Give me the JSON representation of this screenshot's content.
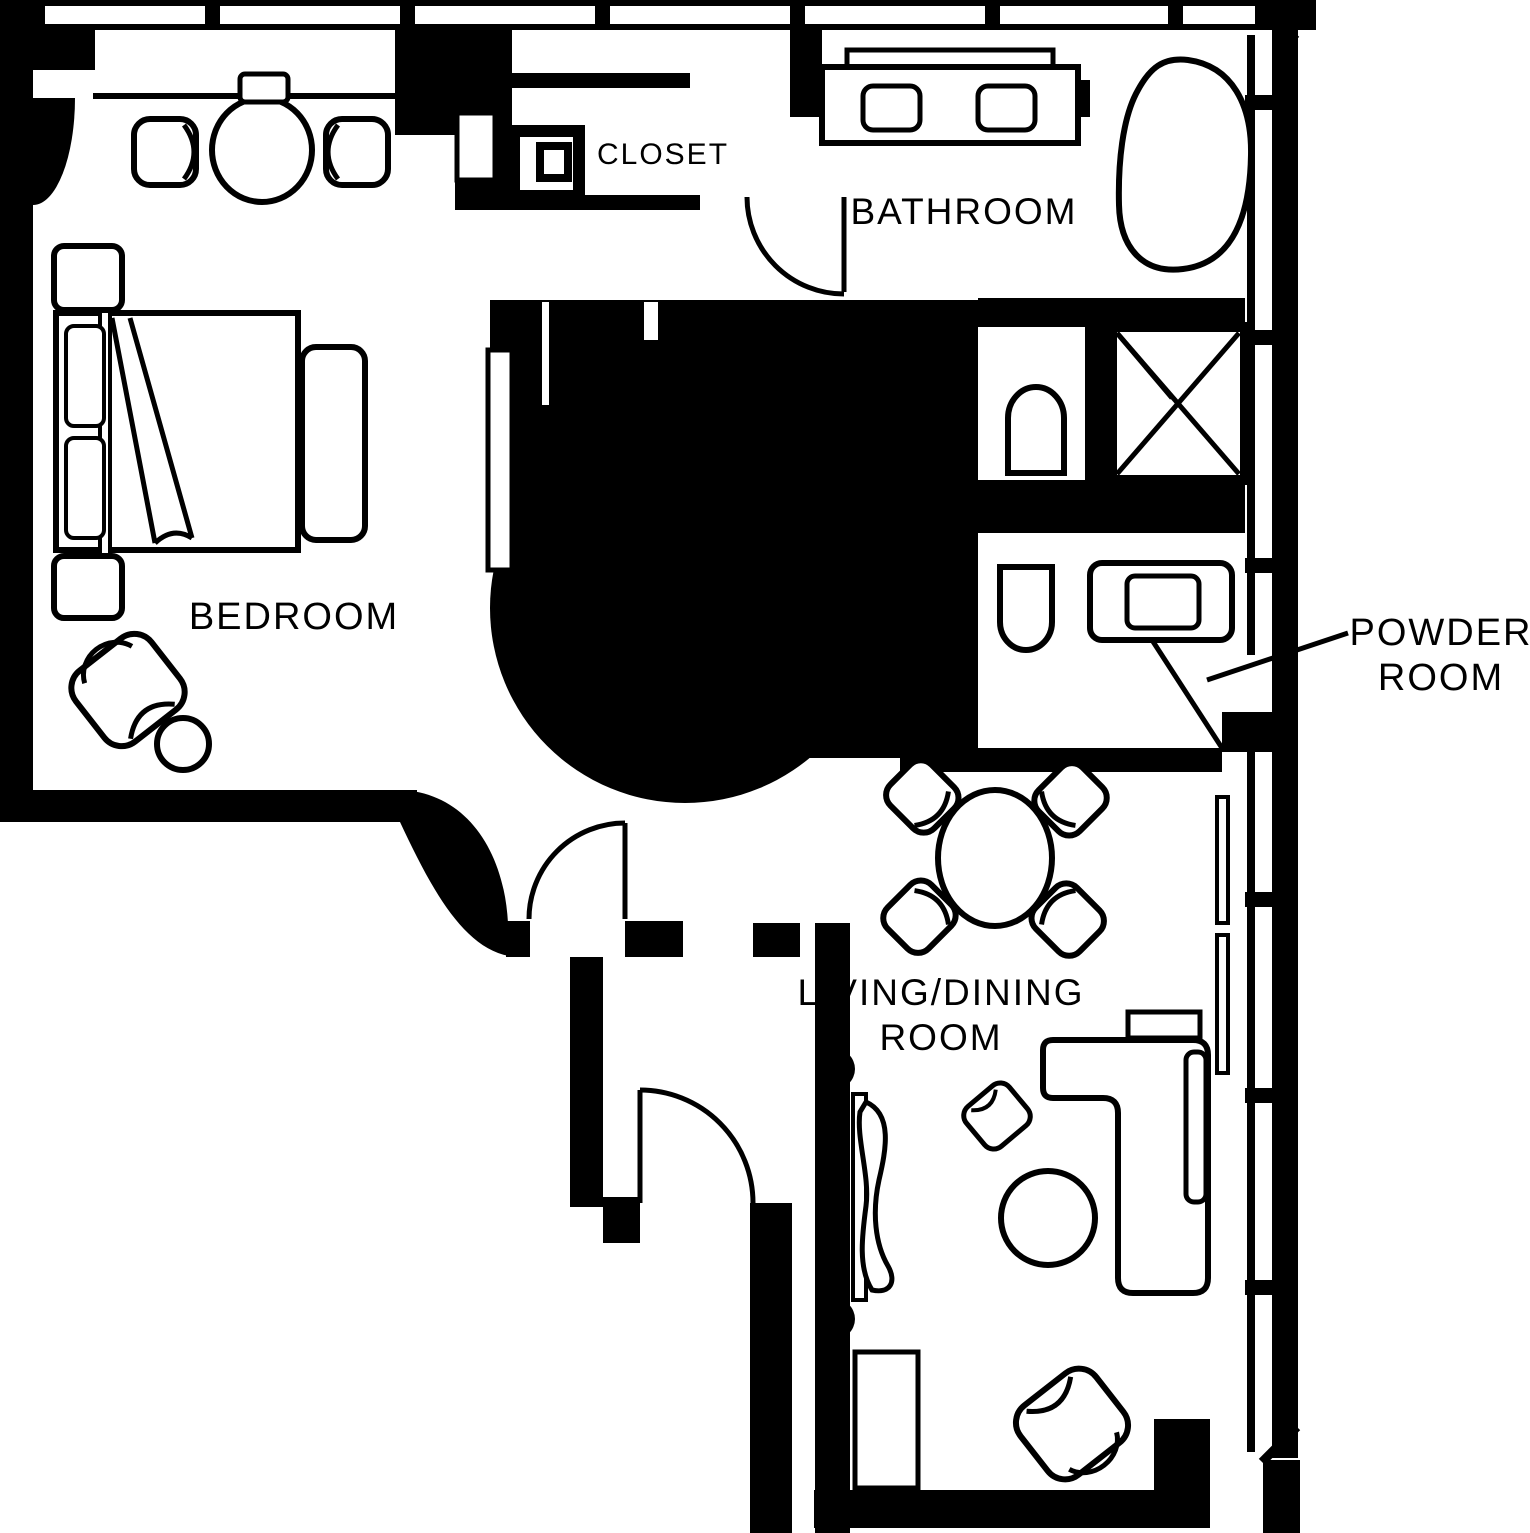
{
  "floor_plan": {
    "background_color": "#ffffff",
    "line_color": "#000000",
    "rooms": {
      "bedroom": {
        "label": "BEDROOM",
        "furniture": [
          "bed",
          "pillows",
          "nightstand",
          "nightstand",
          "foot-bench",
          "round-table",
          "chair",
          "chair",
          "armchair",
          "side-table"
        ]
      },
      "closet": {
        "label": "CLOSET",
        "furniture": [
          "column",
          "sliding-door"
        ]
      },
      "bathroom": {
        "label": "BATHROOM",
        "furniture": [
          "double-sink-vanity",
          "bathtub",
          "toilet",
          "shower"
        ]
      },
      "powder_room": {
        "label_line1": "POWDER",
        "label_line2": "ROOM",
        "furniture": [
          "toilet",
          "sink-vanity"
        ]
      },
      "living_dining": {
        "label_line1": "LIVING/DINING",
        "label_line2": "ROOM",
        "furniture": [
          "dining-table",
          "dining-chair",
          "dining-chair",
          "dining-chair",
          "dining-chair",
          "sectional-sofa",
          "coffee-table",
          "armchair",
          "ottoman",
          "tv-console",
          "cabinet"
        ]
      }
    }
  }
}
